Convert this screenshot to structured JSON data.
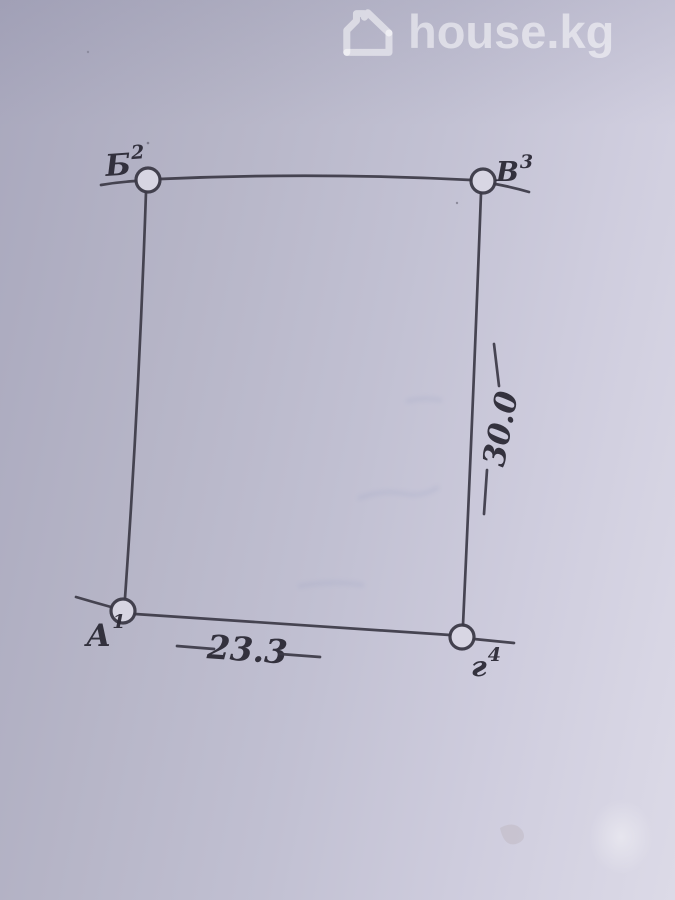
{
  "watermark": {
    "brand": "house.kg",
    "icon": "house-outline-icon"
  },
  "sketch": {
    "kind": "hand-drawn land plot survey sketch",
    "corners": [
      {
        "label": "Б",
        "sup": "2",
        "position": "top-left"
      },
      {
        "label": "В",
        "sup": "3",
        "position": "top-right"
      },
      {
        "label": "А",
        "sup": "1",
        "position": "bottom-left"
      },
      {
        "label": "г",
        "sup": "4",
        "position": "bottom-right"
      }
    ],
    "dimensions": [
      {
        "value": "23.3",
        "edge": "bottom edge А–г"
      },
      {
        "value": "30.0",
        "edge": "right edge В–г"
      }
    ]
  },
  "colors": {
    "ink": "#3c3a47",
    "paper_dark": "#a9a8bd",
    "paper_mid": "#c1c0d2",
    "paper_light": "#dcdae7",
    "watermark": "rgba(255,255,255,0.52)"
  }
}
